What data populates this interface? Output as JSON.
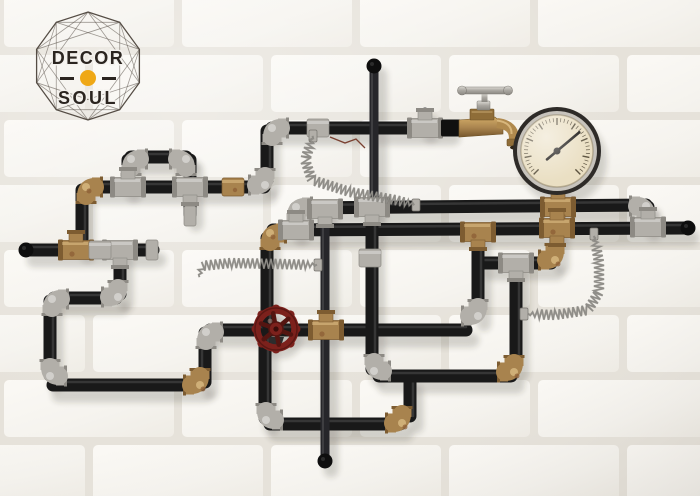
{
  "brand": {
    "line1": "DECOR",
    "line2": "SOUL",
    "dot_color": "#EFA816",
    "frame_color": "#554D45",
    "text_color": "#2B2520",
    "frame": {
      "cx": 88,
      "cy": 66,
      "r": 54,
      "sides": 10,
      "chord_skips": [
        2,
        3
      ]
    }
  },
  "scene": {
    "description": "industrial-steampunk-pipe-wall-decor-on-white-brick-wall",
    "wall": {
      "brick_color": "#F6F4EF",
      "mortar_color": "#E6E2DA",
      "brick_w": 170,
      "brick_h": 57,
      "gap": 8,
      "row_h": 65,
      "period": 178
    },
    "palette": {
      "pipe": "#191919",
      "rod": "#26262a",
      "silver": "#b2afa9",
      "silver_dark": "#8d8a84",
      "silver_hi": "#e2dfd9",
      "brass": "#a8834e",
      "brass_dark": "#7d5c31",
      "rust": "#8a5b33",
      "spring": "#8f8d88",
      "spring_dark": "#6a6862",
      "shadow": "rgba(45,40,34,0.35)",
      "wire": "#7a4030"
    },
    "pipes": [
      [
        272,
        128,
        447,
        128
      ],
      [
        267,
        131,
        267,
        180
      ],
      [
        90,
        187,
        264,
        187
      ],
      [
        82,
        190,
        82,
        246
      ],
      [
        28,
        250,
        153,
        250
      ],
      [
        128,
        160,
        128,
        186
      ],
      [
        131,
        157,
        186,
        157
      ],
      [
        190,
        160,
        190,
        214
      ],
      [
        120,
        252,
        120,
        294
      ],
      [
        54,
        298,
        116,
        298
      ],
      [
        50,
        301,
        50,
        375
      ],
      [
        53,
        385,
        200,
        385
      ],
      [
        205,
        382,
        205,
        333
      ],
      [
        210,
        330,
        466,
        330
      ],
      [
        267,
        238,
        267,
        323
      ],
      [
        265,
        336,
        265,
        418
      ],
      [
        270,
        424,
        400,
        424
      ],
      [
        410,
        381,
        410,
        416
      ],
      [
        273,
        230,
        686,
        228
      ],
      [
        296,
        208,
        646,
        205
      ],
      [
        296,
        211,
        296,
        229
      ],
      [
        372,
        211,
        372,
        369
      ],
      [
        379,
        376,
        511,
        376
      ],
      [
        516,
        262,
        516,
        364
      ],
      [
        484,
        263,
        551,
        263
      ],
      [
        556,
        233,
        556,
        257
      ],
      [
        478,
        234,
        478,
        314
      ],
      [
        648,
        207,
        648,
        224
      ],
      [
        558,
        188,
        558,
        224
      ]
    ],
    "rods": [
      [
        374,
        65,
        374,
        206
      ],
      [
        325,
        209,
        325,
        460
      ],
      [
        425,
        112,
        425,
        126
      ]
    ],
    "elbows": [
      [
        272,
        128,
        "R",
        "D",
        "s"
      ],
      [
        265,
        185,
        "U",
        "L",
        "s"
      ],
      [
        86,
        187,
        "R",
        "D",
        "b"
      ],
      [
        131,
        159,
        "D",
        "R",
        "s"
      ],
      [
        186,
        159,
        "L",
        "D",
        "s"
      ],
      [
        118,
        297,
        "L",
        "U",
        "s"
      ],
      [
        52,
        299,
        "R",
        "D",
        "s"
      ],
      [
        50,
        376,
        "U",
        "R",
        "s"
      ],
      [
        200,
        385,
        "L",
        "U",
        "b"
      ],
      [
        206,
        332,
        "D",
        "R",
        "s"
      ],
      [
        270,
        233,
        "D",
        "R",
        "b"
      ],
      [
        266,
        420,
        "U",
        "R",
        "s"
      ],
      [
        402,
        423,
        "L",
        "U",
        "b"
      ],
      [
        296,
        207,
        "R",
        "D",
        "s"
      ],
      [
        646,
        206,
        "L",
        "D",
        "s"
      ],
      [
        374,
        371,
        "U",
        "R",
        "s"
      ],
      [
        514,
        372,
        "L",
        "U",
        "b"
      ],
      [
        555,
        260,
        "L",
        "U",
        "b"
      ],
      [
        478,
        316,
        "U",
        "L",
        "s"
      ]
    ],
    "tees": [
      [
        425,
        128,
        "U",
        "s"
      ],
      [
        76,
        250,
        "U",
        "b"
      ],
      [
        120,
        250,
        "D",
        "s"
      ],
      [
        190,
        187,
        "D",
        "s"
      ],
      [
        128,
        187,
        "U",
        "s"
      ],
      [
        372,
        207,
        "D",
        "s"
      ],
      [
        325,
        209,
        "D",
        "s"
      ],
      [
        558,
        207,
        "UD",
        "b"
      ],
      [
        478,
        232,
        "D",
        "b"
      ],
      [
        516,
        263,
        "D",
        "s"
      ],
      [
        296,
        230,
        "U",
        "s"
      ],
      [
        557,
        228,
        "UD",
        "b"
      ],
      [
        648,
        227,
        "U",
        "s"
      ],
      [
        326,
        330,
        "U",
        "b"
      ]
    ],
    "couplings": [
      [
        233,
        187,
        "b"
      ],
      [
        100,
        250,
        "s"
      ],
      [
        370,
        258,
        "s"
      ],
      [
        318,
        128,
        "s"
      ]
    ],
    "caps": [
      [
        26,
        250
      ],
      [
        688,
        228
      ],
      [
        374,
        66
      ],
      [
        325,
        461
      ]
    ],
    "sleeve_caps": [
      [
        152,
        250
      ],
      [
        190,
        216
      ]
    ],
    "clamps": [
      [
        318,
        265
      ],
      [
        524,
        314
      ],
      [
        594,
        234
      ],
      [
        416,
        205
      ],
      [
        313,
        136
      ]
    ],
    "springs": [
      [
        [
          313,
          136
        ],
        [
          305,
          160
        ],
        [
          312,
          180
        ],
        [
          350,
          192
        ],
        [
          395,
          200
        ],
        [
          416,
          205
        ]
      ],
      [
        [
          594,
          236
        ],
        [
          599,
          262
        ],
        [
          599,
          292
        ],
        [
          588,
          310
        ],
        [
          555,
          315
        ],
        [
          527,
          314
        ]
      ],
      [
        [
          199,
          277
        ],
        [
          202,
          266
        ],
        [
          230,
          263
        ],
        [
          280,
          264
        ],
        [
          317,
          265
        ]
      ]
    ],
    "wire": [
      [
        330,
        137
      ],
      [
        345,
        143
      ],
      [
        356,
        139
      ],
      [
        365,
        148
      ]
    ],
    "gauge": {
      "cx": 557,
      "cy": 151,
      "r": 44,
      "rim": "#2e2b28",
      "bezel": "#c7c3bc",
      "face": "#EADFC3",
      "tick_color": "#5c5340",
      "ticks": 40,
      "sweep_deg": 270,
      "needle_angle_deg": -40,
      "needle_color": "#15120f"
    },
    "faucet": {
      "x": 444,
      "y": 128,
      "body": "#b08a4e",
      "handle": "#b2afa9"
    },
    "valve": {
      "cx": 276,
      "cy": 329,
      "r": 22,
      "color": "#7C211C",
      "dark": "#541511",
      "spokes": 6
    }
  }
}
